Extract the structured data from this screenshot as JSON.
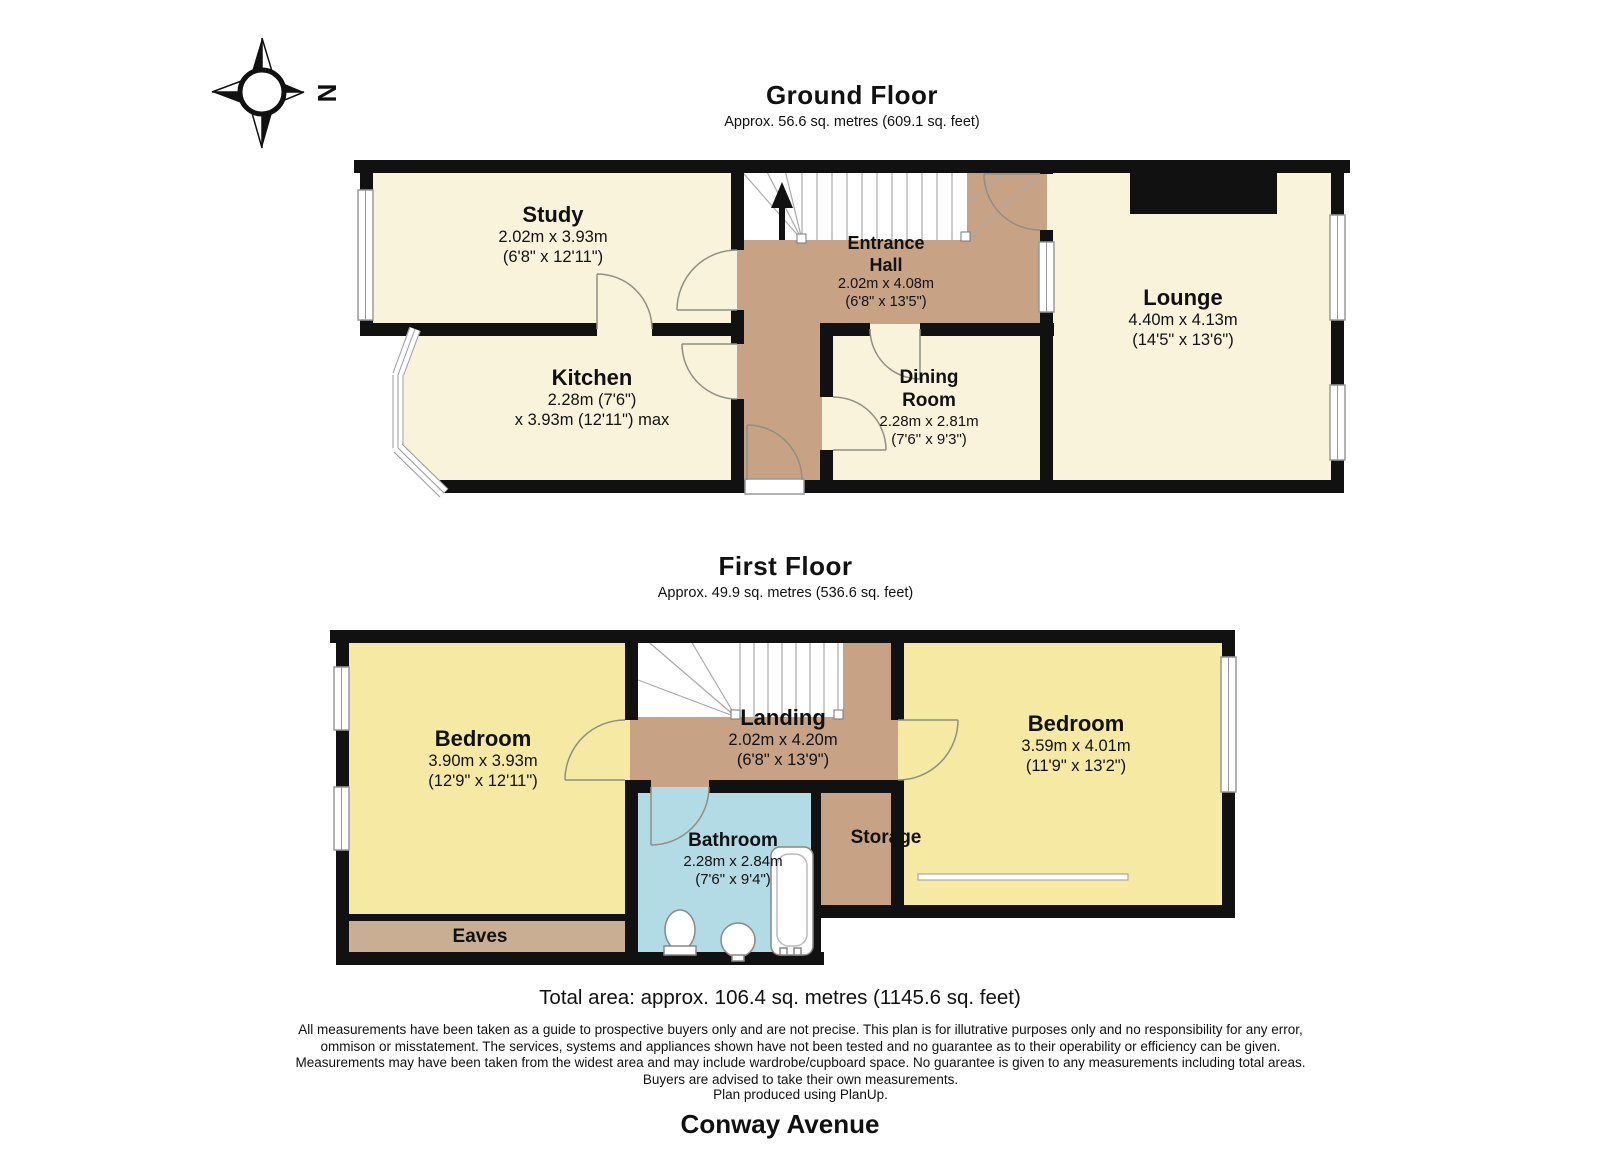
{
  "compass": {
    "north_label": "N"
  },
  "ground_floor": {
    "title": "Ground Floor",
    "subtitle": "Approx. 56.6 sq. metres (609.1 sq. feet)",
    "rooms": {
      "study": {
        "name": "Study",
        "dim_metric": "2.02m x 3.93m",
        "dim_imperial": "(6'8\" x 12'11\")"
      },
      "entrance_hall": {
        "name_line1": "Entrance",
        "name_line2": "Hall",
        "dim_metric": "2.02m x 4.08m",
        "dim_imperial": "(6'8\" x 13'5\")"
      },
      "lounge": {
        "name": "Lounge",
        "dim_metric": "4.40m x 4.13m",
        "dim_imperial": "(14'5\" x 13'6\")"
      },
      "kitchen": {
        "name": "Kitchen",
        "dim_metric": "2.28m (7'6\")",
        "dim_imperial": "x 3.93m (12'11\") max"
      },
      "dining_room": {
        "name_line1": "Dining",
        "name_line2": "Room",
        "dim_metric": "2.28m x 2.81m",
        "dim_imperial": "(7'6\" x 9'3\")"
      }
    }
  },
  "first_floor": {
    "title": "First Floor",
    "subtitle": "Approx. 49.9 sq. metres (536.6 sq. feet)",
    "rooms": {
      "bedroom_left": {
        "name": "Bedroom",
        "dim_metric": "3.90m x 3.93m",
        "dim_imperial": "(12'9\" x 12'11\")"
      },
      "landing": {
        "name": "Landing",
        "dim_metric": "2.02m x 4.20m",
        "dim_imperial": "(6'8\" x 13'9\")"
      },
      "bedroom_right": {
        "name": "Bedroom",
        "dim_metric": "3.59m x 4.01m",
        "dim_imperial": "(11'9\" x 13'2\")"
      },
      "bathroom": {
        "name": "Bathroom",
        "dim_metric": "2.28m x 2.84m",
        "dim_imperial": "(7'6\" x 9'4\")"
      },
      "storage": {
        "name": "Storage"
      },
      "eaves": {
        "name": "Eaves"
      }
    }
  },
  "footer": {
    "total_area": "Total area: approx. 106.4 sq. metres (1145.6 sq. feet)",
    "disclaimer": "All measurements have been taken as a guide to prospective buyers only and are not precise. This plan is for illutrative purposes only and no responsibility for any error, ommison or misstatement. The services, systems and appliances shown have not been tested and no guarantee as to their operability or efficiency can be given. Measurements may have been taken from the widest area and may include wardrobe/cupboard space. No guarantee is given to any measurements including total areas. Buyers are advised to take their own measurements.",
    "produced_by": "Plan produced using PlanUp.",
    "address": "Conway Avenue"
  },
  "colors": {
    "room_cream": "#FAF3DC",
    "room_yellow": "#F5E9A4",
    "hall_brown": "#C8A284",
    "eaves_brown": "#C9AE94",
    "bathroom_blue": "#B3DBE5",
    "wall_black": "#111111"
  }
}
